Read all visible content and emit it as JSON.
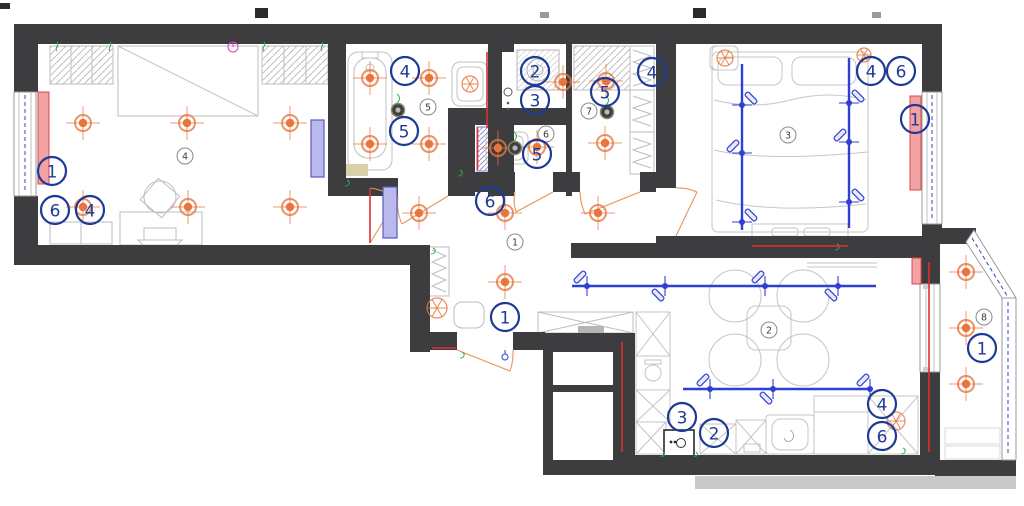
{
  "floor_plan": {
    "colors": {
      "wall": "#3d3d40",
      "callout_blue": "#1d3a96",
      "track_blue": "#2f3fd0",
      "light_orange": "#e8763c",
      "radiator_red": "#f2a2a2",
      "radiator_border": "#d84848",
      "line_red": "#e03030",
      "door_purple_fill": "#b9b9ee",
      "door_purple_border": "#5b5bc0",
      "furniture_gray": "#c2c2c2",
      "accent_green": "#3aa84a",
      "accent_magenta": "#cc44cc",
      "room_number_stroke": "#8a8a8a",
      "room_number_text": "#3c3c3c"
    },
    "callouts": [
      {
        "label": "1",
        "x": 52,
        "y": 171
      },
      {
        "label": "6",
        "x": 55,
        "y": 210
      },
      {
        "label": "4",
        "x": 90,
        "y": 210
      },
      {
        "label": "4",
        "x": 405,
        "y": 71
      },
      {
        "label": "5",
        "x": 404,
        "y": 131
      },
      {
        "label": "2",
        "x": 535,
        "y": 71
      },
      {
        "label": "3",
        "x": 535,
        "y": 100
      },
      {
        "label": "5",
        "x": 605,
        "y": 92
      },
      {
        "label": "4",
        "x": 652,
        "y": 72
      },
      {
        "label": "5",
        "x": 537,
        "y": 154
      },
      {
        "label": "6",
        "x": 490,
        "y": 201
      },
      {
        "label": "1",
        "x": 505,
        "y": 317
      },
      {
        "label": "4",
        "x": 871,
        "y": 71
      },
      {
        "label": "6",
        "x": 901,
        "y": 71
      },
      {
        "label": "1",
        "x": 915,
        "y": 119
      },
      {
        "label": "1",
        "x": 982,
        "y": 348
      },
      {
        "label": "4",
        "x": 882,
        "y": 404
      },
      {
        "label": "6",
        "x": 882,
        "y": 436
      },
      {
        "label": "3",
        "x": 682,
        "y": 417
      },
      {
        "label": "2",
        "x": 714,
        "y": 433
      }
    ],
    "room_numbers": [
      {
        "label": "4",
        "x": 185,
        "y": 156
      },
      {
        "label": "5",
        "x": 428,
        "y": 107
      },
      {
        "label": "6",
        "x": 546,
        "y": 134
      },
      {
        "label": "7",
        "x": 589,
        "y": 111
      },
      {
        "label": "3",
        "x": 788,
        "y": 135
      },
      {
        "label": "1",
        "x": 515,
        "y": 242
      },
      {
        "label": "2",
        "x": 769,
        "y": 330
      },
      {
        "label": "8",
        "x": 984,
        "y": 317
      }
    ],
    "ceiling_lights": [
      {
        "x": 83,
        "y": 123
      },
      {
        "x": 187,
        "y": 123
      },
      {
        "x": 290,
        "y": 123
      },
      {
        "x": 83,
        "y": 207
      },
      {
        "x": 188,
        "y": 207
      },
      {
        "x": 290,
        "y": 207
      },
      {
        "x": 370,
        "y": 78
      },
      {
        "x": 429,
        "y": 78
      },
      {
        "x": 370,
        "y": 144
      },
      {
        "x": 429,
        "y": 144
      },
      {
        "x": 563,
        "y": 82
      },
      {
        "x": 606,
        "y": 81
      },
      {
        "x": 605,
        "y": 143
      },
      {
        "x": 498,
        "y": 148
      },
      {
        "x": 537,
        "y": 147
      },
      {
        "x": 419,
        "y": 213
      },
      {
        "x": 505,
        "y": 213
      },
      {
        "x": 598,
        "y": 213
      },
      {
        "x": 505,
        "y": 282
      },
      {
        "x": 966,
        "y": 272
      },
      {
        "x": 966,
        "y": 328
      },
      {
        "x": 966,
        "y": 384
      }
    ],
    "extract_fans": [
      {
        "x": 470,
        "y": 84,
        "r": 8,
        "box": false
      },
      {
        "x": 437,
        "y": 308,
        "r": 10,
        "box": false
      },
      {
        "x": 725,
        "y": 58,
        "r": 8,
        "box": true
      },
      {
        "x": 864,
        "y": 55,
        "r": 7,
        "box": false
      },
      {
        "x": 896,
        "y": 421,
        "r": 9,
        "box": false
      }
    ],
    "vent_fans_dark": [
      {
        "x": 398,
        "y": 110
      },
      {
        "x": 515,
        "y": 148
      },
      {
        "x": 607,
        "y": 112
      }
    ],
    "track_lights": [
      {
        "x1": 572,
        "y1": 286,
        "x2": 876,
        "y2": 286,
        "spots": [
          {
            "x": 587,
            "y": 286
          },
          {
            "x": 665,
            "y": 286
          },
          {
            "x": 765,
            "y": 286
          },
          {
            "x": 838,
            "y": 286
          }
        ]
      },
      {
        "x1": 683,
        "y1": 389,
        "x2": 872,
        "y2": 389,
        "spots": [
          {
            "x": 710,
            "y": 389
          },
          {
            "x": 773,
            "y": 389
          },
          {
            "x": 870,
            "y": 389
          }
        ]
      },
      {
        "x1": 742,
        "y1": 64,
        "x2": 742,
        "y2": 230,
        "spots": [
          {
            "x": 742,
            "y": 105
          },
          {
            "x": 742,
            "y": 153
          },
          {
            "x": 742,
            "y": 222
          }
        ]
      },
      {
        "x1": 849,
        "y1": 58,
        "x2": 849,
        "y2": 228,
        "spots": [
          {
            "x": 849,
            "y": 103
          },
          {
            "x": 849,
            "y": 142
          },
          {
            "x": 849,
            "y": 202
          }
        ]
      }
    ],
    "radiators": [
      {
        "x": 38,
        "y": 92,
        "w": 11,
        "h": 92
      },
      {
        "x": 910,
        "y": 96,
        "w": 11,
        "h": 94
      },
      {
        "x": 912,
        "y": 258,
        "w": 9,
        "h": 26
      }
    ],
    "door_panels": [
      {
        "x": 311,
        "y": 120,
        "w": 13,
        "h": 57
      },
      {
        "x": 383,
        "y": 187,
        "w": 14,
        "h": 51
      }
    ],
    "red_lines": [
      {
        "x1": 487,
        "y1": 52,
        "x2": 487,
        "y2": 128
      },
      {
        "x1": 477.5,
        "y1": 127,
        "x2": 477.5,
        "y2": 170
      },
      {
        "x1": 370,
        "y1": 188,
        "x2": 370,
        "y2": 243
      },
      {
        "x1": 622,
        "y1": 342,
        "x2": 622,
        "y2": 452
      },
      {
        "x1": 929,
        "y1": 262,
        "x2": 929,
        "y2": 452
      },
      {
        "x1": 752,
        "y1": 246,
        "x2": 848,
        "y2": 246
      },
      {
        "x1": 432,
        "y1": 348,
        "x2": 456,
        "y2": 348
      }
    ]
  }
}
